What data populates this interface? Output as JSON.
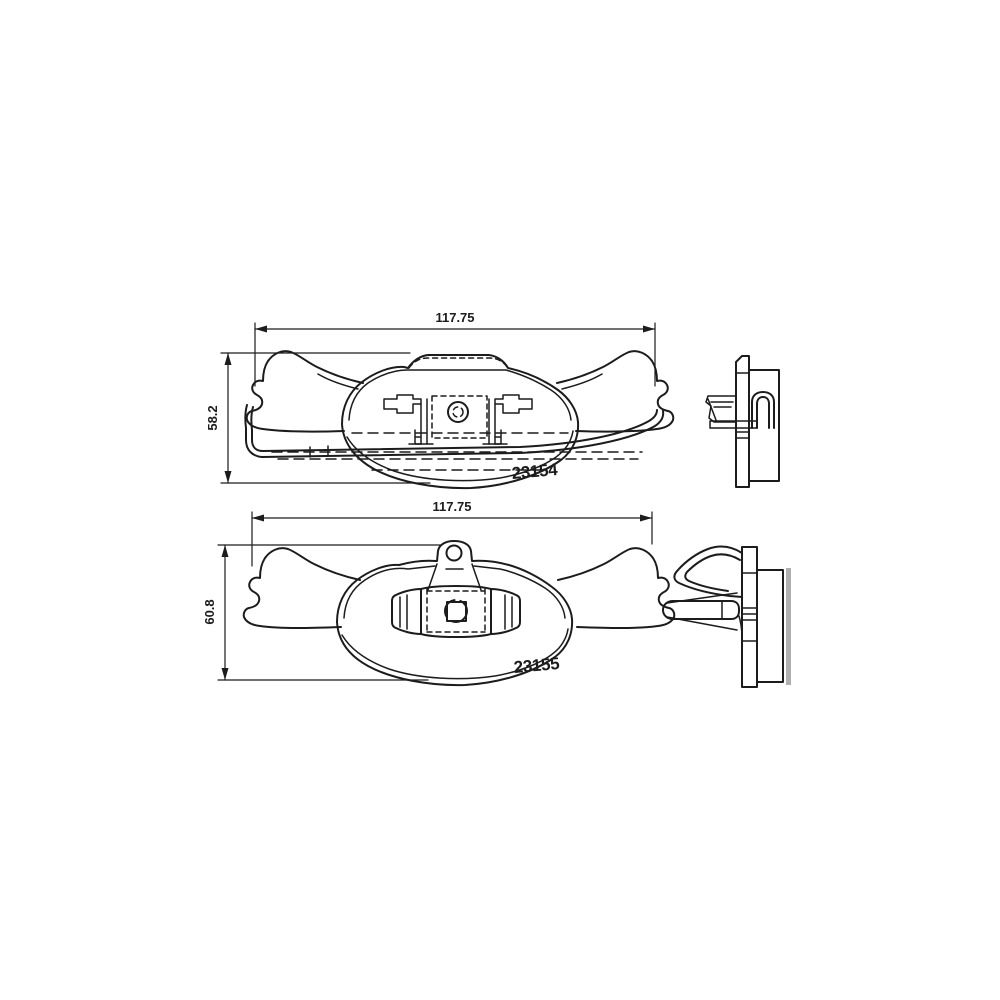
{
  "colors": {
    "line": "#1c1c1c",
    "rotor_gray": "#b0b0b0",
    "background": "#ffffff"
  },
  "views": {
    "front_top": {
      "part_number": "23154",
      "width": "117.75",
      "height": "58.2"
    },
    "front_bottom": {
      "part_number": "23155",
      "width": "117.75",
      "height": "60.8"
    }
  }
}
